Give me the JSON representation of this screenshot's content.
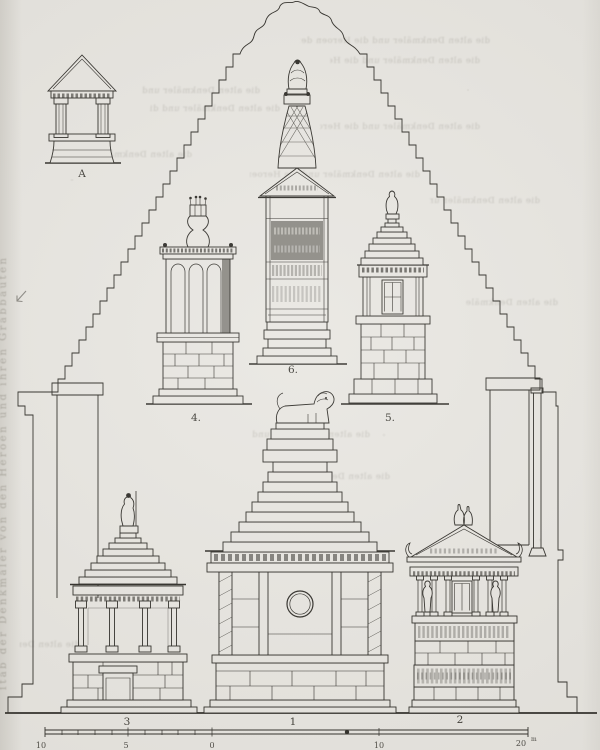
{
  "plate": {
    "figure_labels": {
      "a": "A",
      "n1": "1",
      "n2": "2",
      "n3": "3",
      "n4": "4.",
      "n5": "5.",
      "n6": "6."
    },
    "scale": {
      "left_ticks": [
        "10",
        "5",
        "0"
      ],
      "right_ticks": [
        "10"
      ],
      "end_value": "20",
      "end_unit": "m"
    },
    "colors": {
      "paper": "#e8e6e1",
      "ink": "#2b2924"
    },
    "artifacts": {
      "left_margin_text": "ſtab der Denkmäler von den Heroen und ihren Grabbauten",
      "showthrough_fragment": "die alten Denkmäler und die Heroen der Baukunſt in den Städten"
    }
  }
}
